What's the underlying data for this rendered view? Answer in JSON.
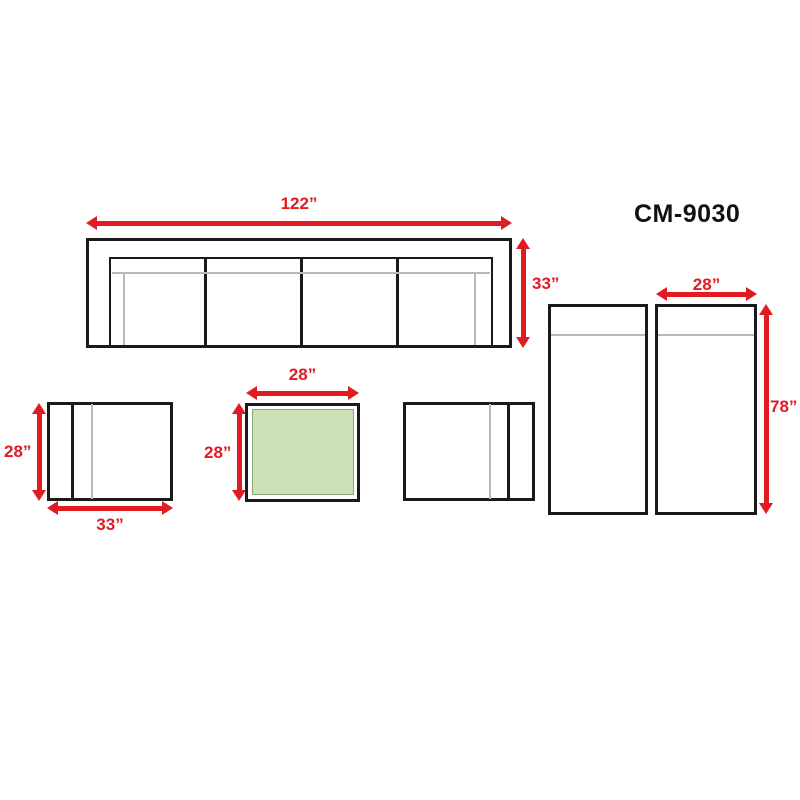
{
  "model": "CM-9030",
  "colors": {
    "arrow_red": "#e01b22",
    "outline_black": "#1a1a1a",
    "detail_gray": "#b9b9b9",
    "table_green_fill": "#cbe2b6",
    "table_green_border": "#8aa873",
    "background": "#ffffff"
  },
  "labels": {
    "sofa_width": "122”",
    "sofa_depth": "33”",
    "chaise_width": "28”",
    "chaise_length": "78”",
    "side_chair_width": "33”",
    "side_chair_depth": "28”",
    "coffee_table_width": "28”",
    "coffee_table_depth": "28”"
  }
}
